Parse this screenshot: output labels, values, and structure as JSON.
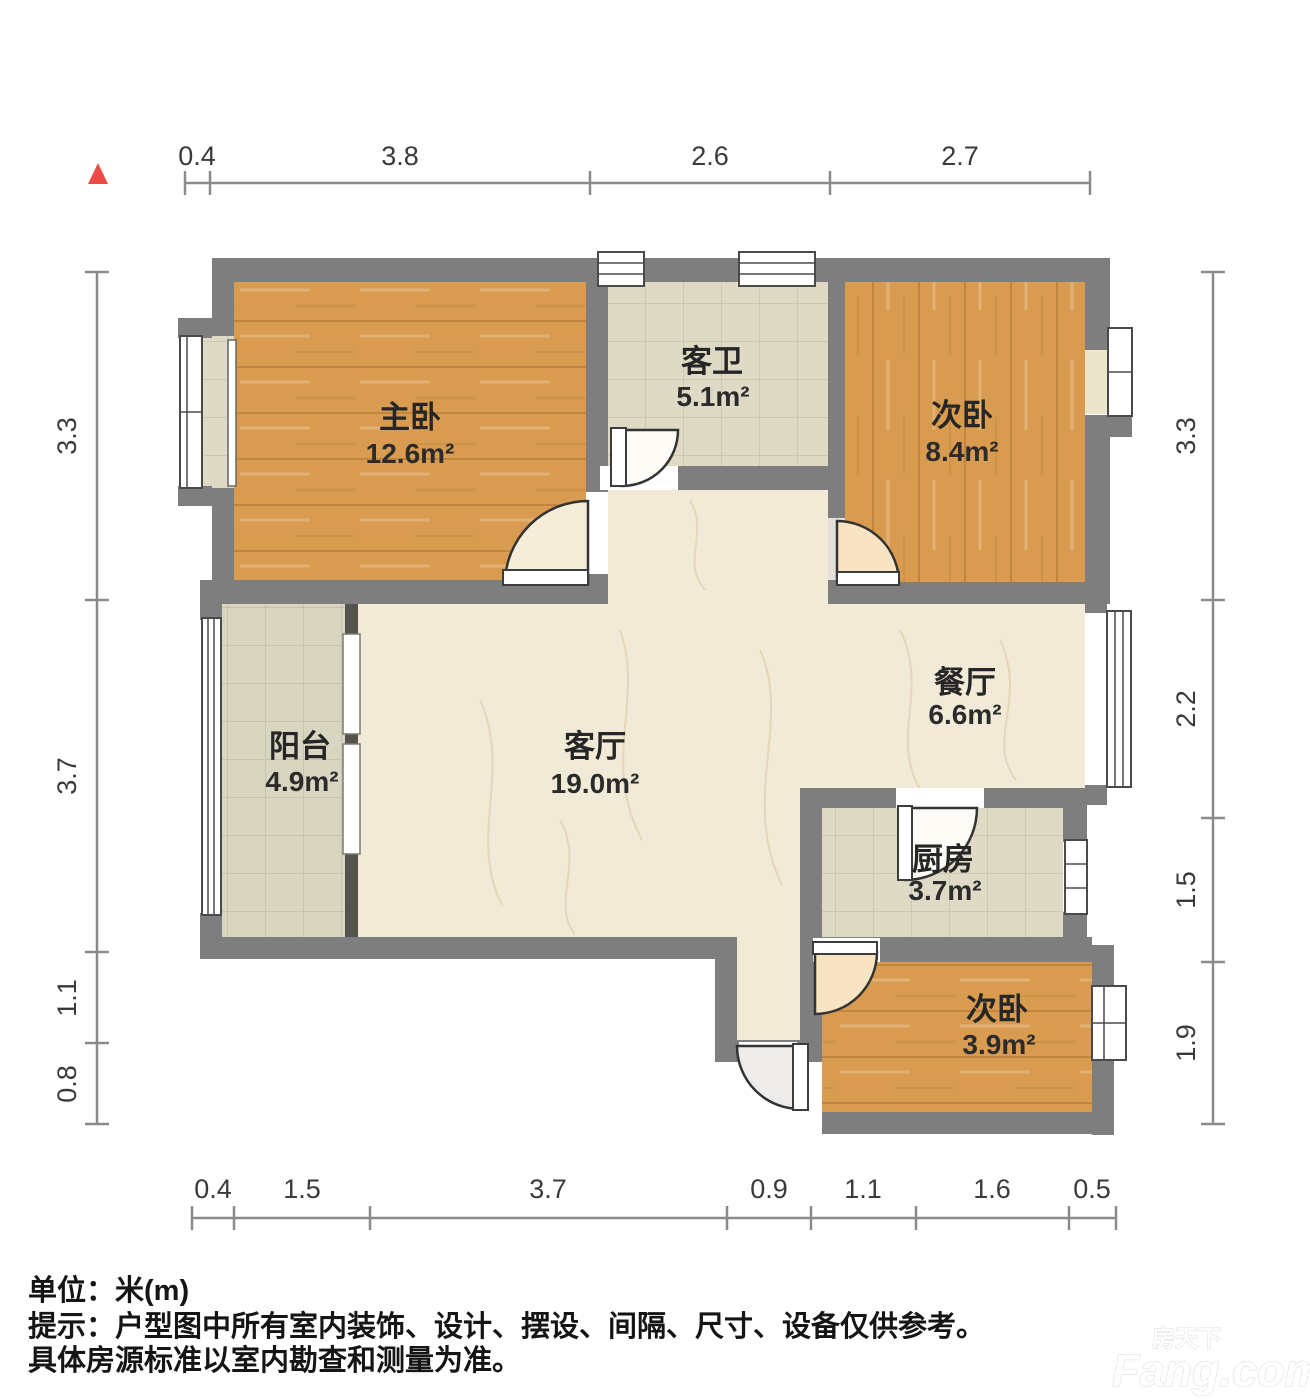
{
  "rooms": {
    "master": {
      "name": "主卧",
      "area": "12.6m²"
    },
    "bath": {
      "name": "客卫",
      "area": "5.1m²"
    },
    "bed2": {
      "name": "次卧",
      "area": "8.4m²"
    },
    "balcony": {
      "name": "阳台",
      "area": "4.9m²"
    },
    "living": {
      "name": "客厅",
      "area": "19.0m²"
    },
    "dining": {
      "name": "餐厅",
      "area": "6.6m²"
    },
    "kitchen": {
      "name": "厨房",
      "area": "3.7m²"
    },
    "bed3": {
      "name": "次卧",
      "area": "3.9m²"
    }
  },
  "dims": {
    "top": [
      "0.4",
      "3.8",
      "2.6",
      "2.7"
    ],
    "left": [
      "3.3",
      "3.7",
      "1.1",
      "0.8"
    ],
    "right": [
      "3.3",
      "2.2",
      "1.5",
      "1.9"
    ],
    "bottom": [
      "0.4",
      "1.5",
      "3.7",
      "0.9",
      "1.1",
      "1.6",
      "0.5"
    ]
  },
  "footer": {
    "unit": "单位：米(m)",
    "note1": "提示：户型图中所有室内装饰、设计、摆设、间隔、尺寸、设备仅供参考。",
    "note2": "具体房源标准以室内勘查和测量为准。"
  },
  "watermark": {
    "cn": "房天下",
    "en": "Fang.com"
  },
  "colors": {
    "wall": "#7E7E7E",
    "wood": "#D89B50",
    "marble": "#F1EAD6",
    "tile": "#DEDAC6",
    "balcony_tile": "#D8D6C0",
    "door_swing": "#F8E3C2",
    "north_marker": "#EC4C48",
    "dark_partition": "#55544C"
  }
}
